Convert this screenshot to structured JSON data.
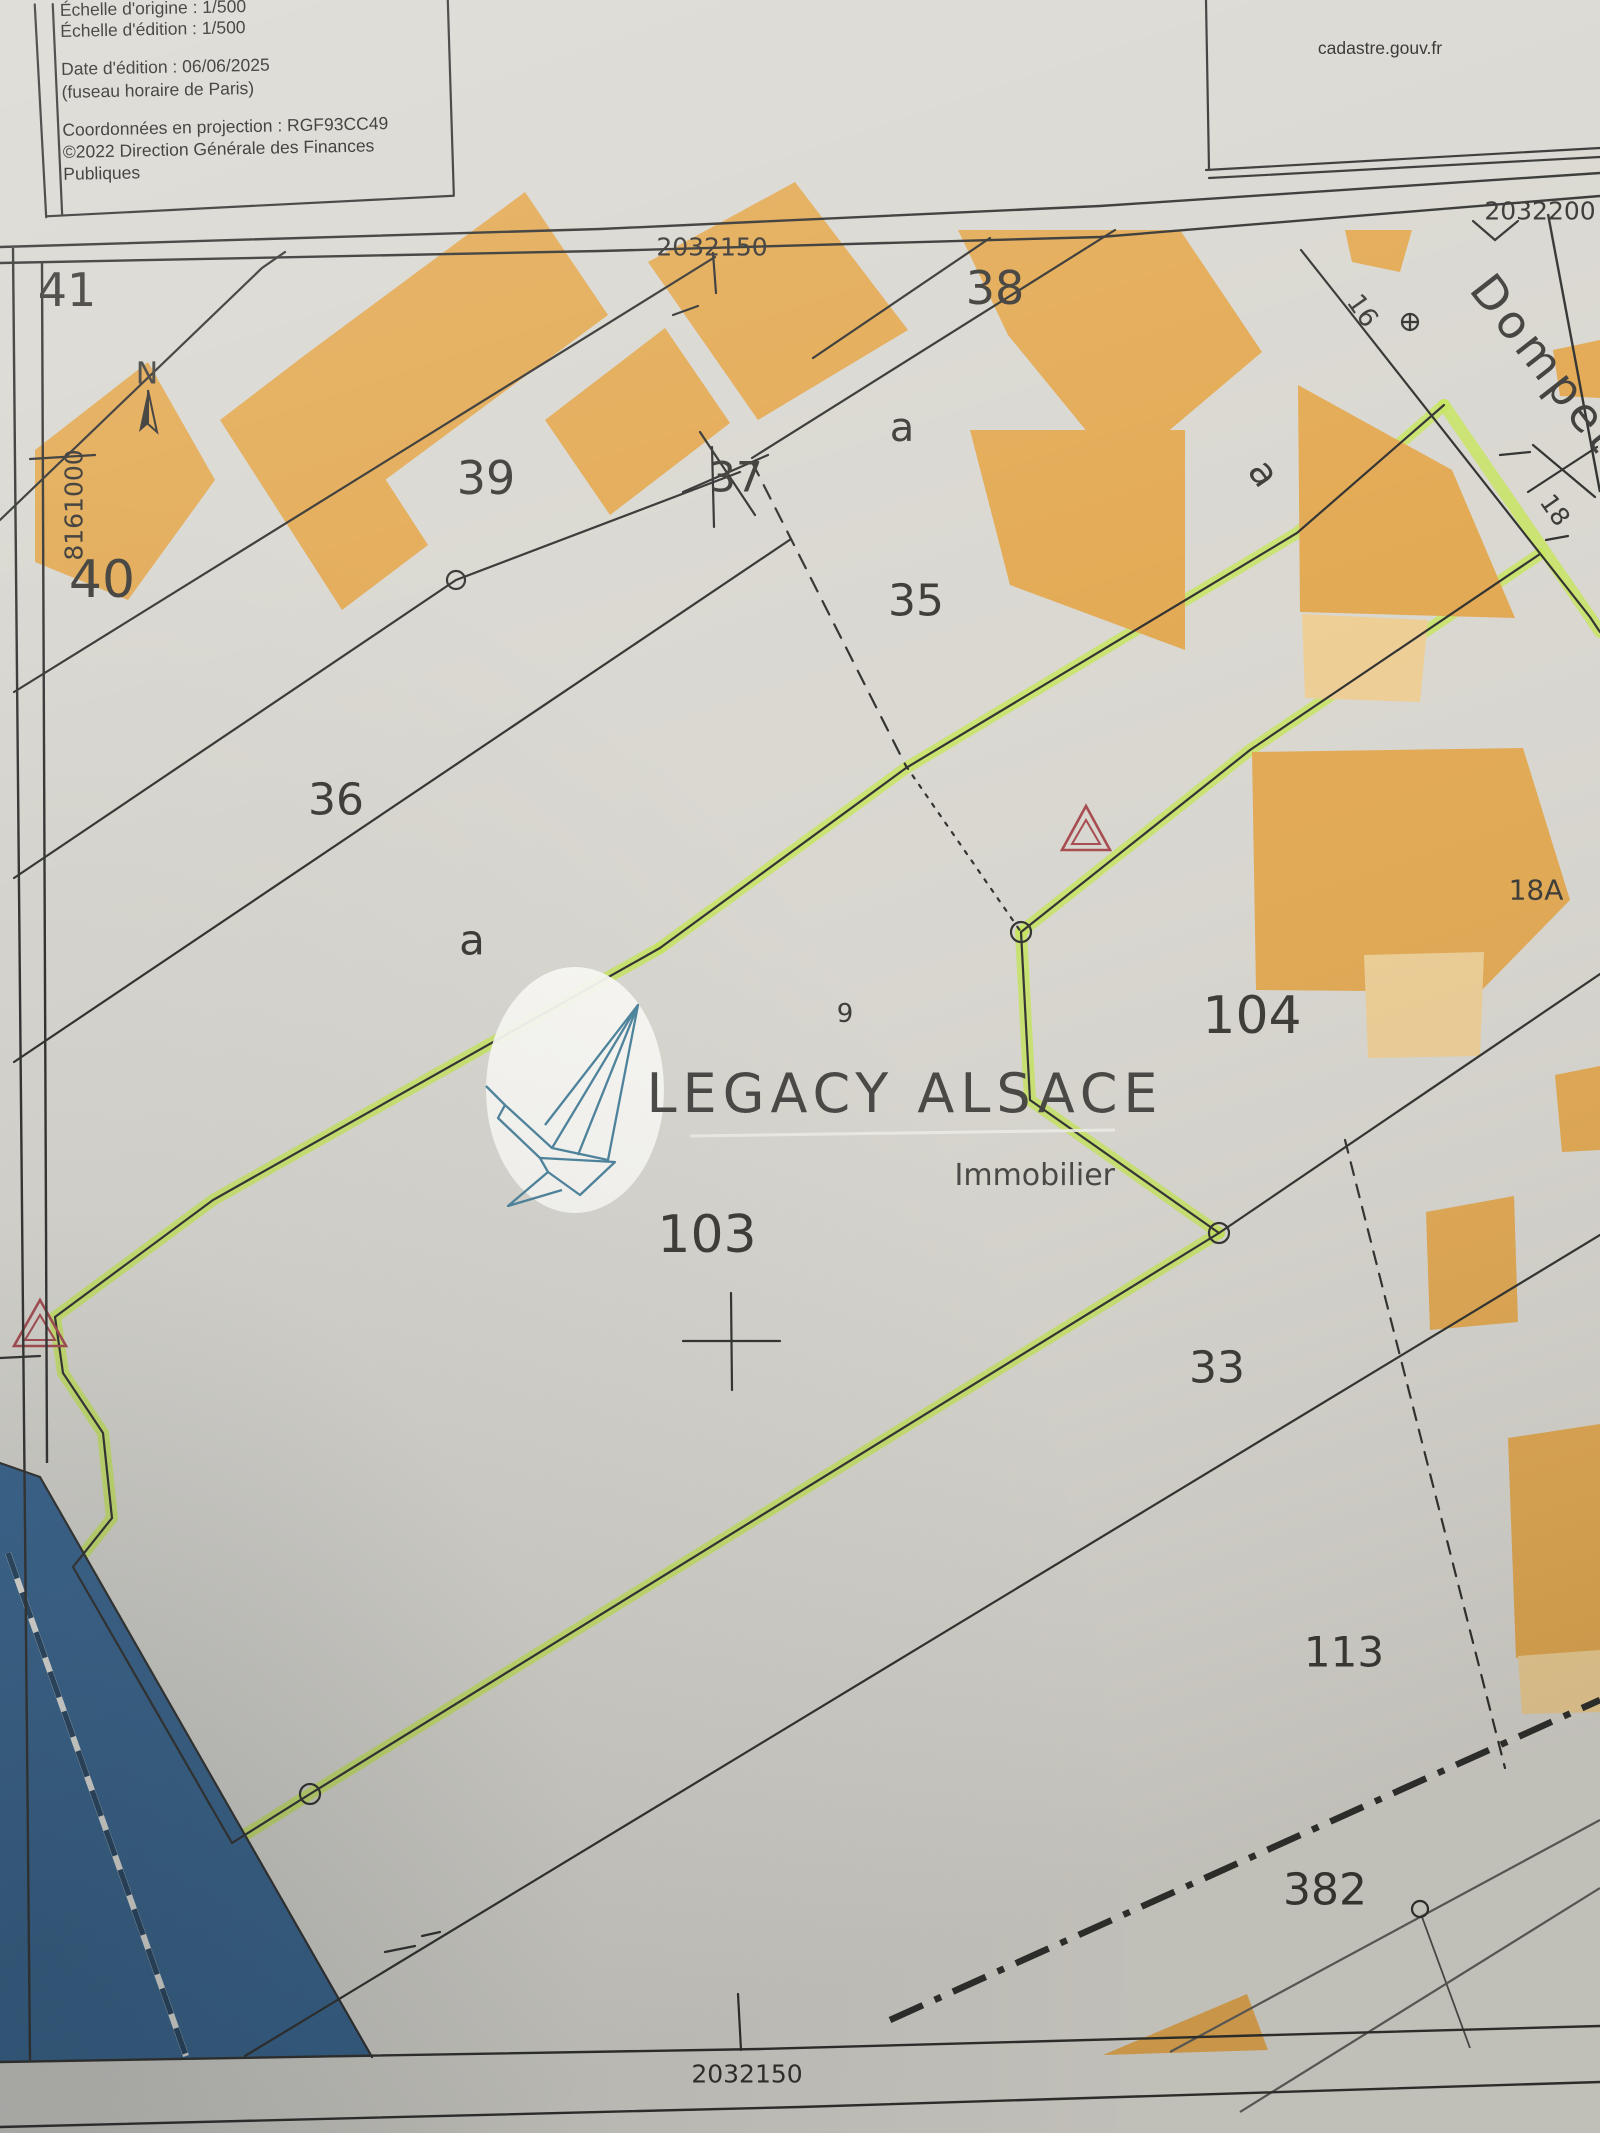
{
  "info_box": {
    "line1": "Échelle d'origine : 1/500",
    "line2": "Échelle d'édition : 1/500",
    "line3": "Date d'édition : 06/06/2025",
    "line4": "(fuseau horaire de Paris)",
    "line5": "Coordonnées en projection : RGF93CC49",
    "line6": "©2022 Direction Générale des Finances",
    "line7": "Publiques"
  },
  "site_box": {
    "url": "cadastre.gouv.fr"
  },
  "grid": {
    "x_top": "2032150",
    "x_top_right": "2032200",
    "x_bottom": "2032150",
    "y_left": "8161000"
  },
  "compass": {
    "north_label": "N"
  },
  "street": {
    "name": "Dompeter"
  },
  "watermark": {
    "brand": "LEGACY ALSACE",
    "tagline": "Immobilier"
  },
  "parcels": {
    "p41": "41",
    "p40": "40",
    "p39": "39",
    "p36": "36",
    "p37": "37",
    "p38": "38",
    "p35": "35",
    "p103": "103",
    "p104": "104",
    "p33": "33",
    "p113": "113",
    "p382": "382",
    "a_left": "a",
    "a_mid": "a",
    "a_street": "a"
  },
  "addresses": {
    "n9": "9",
    "n16": "16",
    "n18": "18",
    "n18a": "18A"
  },
  "colors": {
    "paper": "#d8d6cf",
    "building": "#e2a74e",
    "building_light": "#edcd92",
    "water": "#33618c",
    "highlight": "#c5e457",
    "line": "#2b2b29",
    "triangle": "#a4454a",
    "crane": "#47809a",
    "gray_line": "#5d5b57"
  }
}
